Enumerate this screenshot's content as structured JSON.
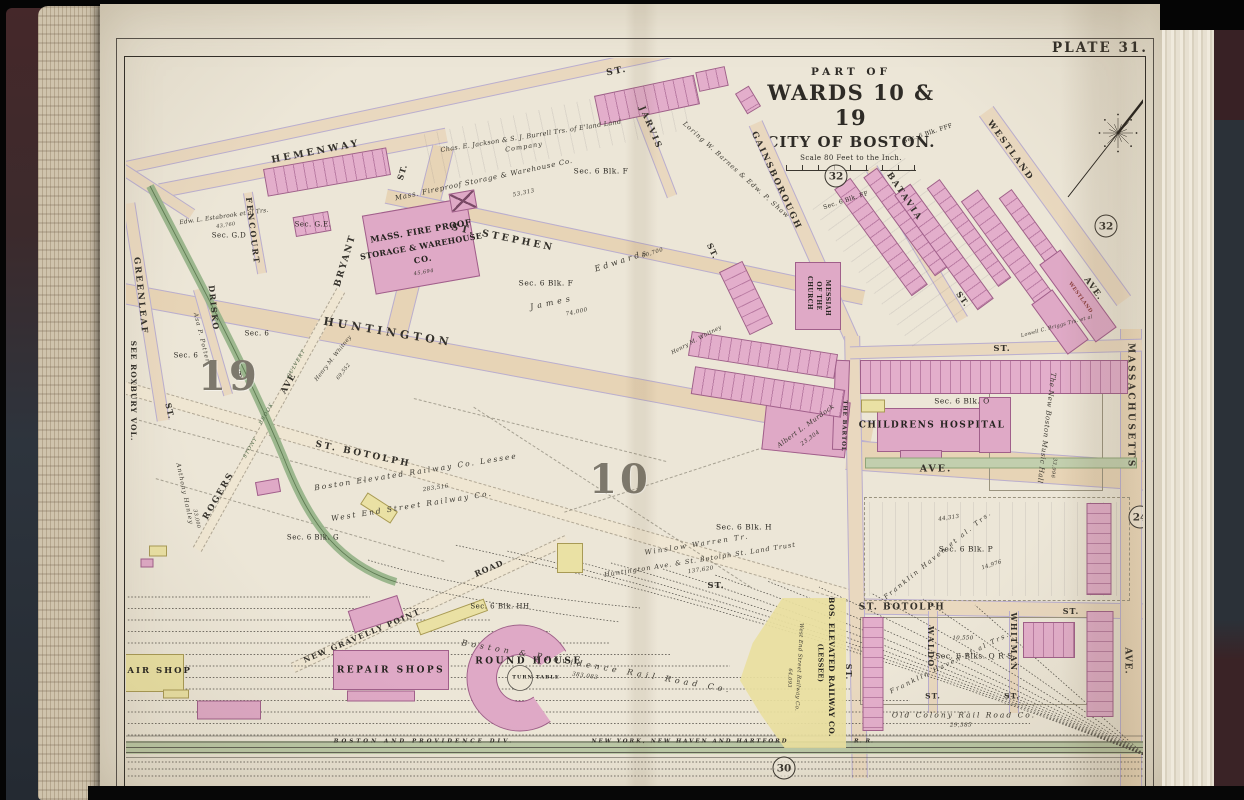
{
  "palette": {
    "page_cream": "#ece6d7",
    "street_fill": "#e9d8bf",
    "street_edge": "#b9aed0",
    "brick_building_pink": "#dfa9c6",
    "wood_building_yellow": "#eae1a4",
    "park_green": "#93b186",
    "ink": "#2c2923"
  },
  "page": {
    "plate_label": "PLATE 31."
  },
  "title_block": {
    "part_of": "PART OF",
    "wards": "WARDS 10 & 19",
    "city": "CITY OF BOSTON.",
    "scale": "Scale 80 Feet to the Inch."
  },
  "wards": {
    "w19": "19",
    "w10": "10"
  },
  "plate_refs": {
    "r32a": "32",
    "r32b": "32",
    "r24": "24",
    "r30": "30"
  },
  "margin_note": "SEE ROXBURY VOL.",
  "streets": {
    "st_top": "ST.",
    "hemenway": "HEMENWAY",
    "fencourt": "FENCOURT",
    "bryant": "BRYANT",
    "bryant_st": "ST.",
    "greenleaf": "GREENLEAF",
    "drisko": "DRISKO",
    "st_stephen": "ST. STEPHEN",
    "huntington": "HUNTINGTON",
    "huntington_ave": "AVE.",
    "gainsborough": "GAINSBOROUGH",
    "jarvis": "JARVIS",
    "batavia": "BATAVIA",
    "batavia_st": "ST.",
    "westland": "WESTLAND",
    "westland_ave": "AVE.",
    "massachusetts": "MASSACHUSETTS",
    "massachusetts_ave": "AVE.",
    "st_botolph_w": "ST. BOTOLPH",
    "st_botolph_e": "ST. BOTOLPH",
    "st_botolph_e_st": "ST.",
    "st_botolph_mid_st": "ST.",
    "rogers": "ROGERS",
    "rogers_ave": "AVE",
    "new_gravelly_point": "NEW GRAVELLY POINT",
    "road": "ROAD",
    "waldo": "WALDO",
    "waldo_st": "ST.",
    "whitman": "WHITMAN",
    "whitman_st": "ST.",
    "st_350": "ST.",
    "st_w1": "ST.",
    "st_w2": "ST.",
    "st_g_mid": "ST.",
    "st_g_low": "ST."
  },
  "culvert": {
    "w1": "STONY",
    "w2": "BROOK",
    "w3": "CULVERT"
  },
  "places": {
    "fireproof_l1": "MASS. FIRE PROOF",
    "fireproof_l2": "STORAGE & WAREHOUSE",
    "fireproof_l3": "CO.",
    "church_l1": "CHURCH",
    "church_l2": "OF THE",
    "church_l3": "MESSIAH",
    "childrens_hospital": "CHILDRENS HOSPITAL",
    "bartol": "THE BARTOL",
    "westland_bldg": "WESTLAND",
    "repair_shop": "REPAIR SHOP",
    "repair_shops": "REPAIR SHOPS",
    "round_house": "ROUND HOUSE",
    "turn_table": "TURN TABLE",
    "bos_elev_1": "BOS. ELEVATED RAILWAY CO.",
    "bos_elev_2": "(LESSEE)",
    "music_hall": "The New Boston Music Hall",
    "music_hall_area": "33,996"
  },
  "owners": {
    "jackson1": "Chas. E. Jackson & S. J. Burrell Trs. of E'land Land",
    "jackson2": "Company",
    "fireproof_owner": "Mass. Fireproof Storage & Warehouse Co.",
    "fireproof_area": "53,313",
    "fireproof_bldg_area": "45,694",
    "estabrook": "Edw. L. Estabrook et al Trs.",
    "estabrook_area": "43,760",
    "barnes": "Loring W. Barnes & Edw. P. Shaw",
    "james": "James",
    "james_area": "74,000",
    "edwards": "Edwards",
    "edwards_area": "60,700",
    "whitney": "Henry M. Whitney",
    "whitney2": "Henry M. Whitney",
    "whitney2_area": "69,552",
    "murdock": "Albert L. Murdock",
    "murdock_area": "23,304",
    "warren1": "Winslow Warren Tr.",
    "warren2": "Huntington Ave. & St. Botolph St. Land Trust",
    "warren_area": "137,620",
    "bera1": "Boston Elevated Railway Co. Lessee",
    "bera2": "West End Street Railway Co.",
    "bera_area": "283,516",
    "potter": "Asa P. Potter",
    "hanley": "Anthony Hanley",
    "hanley_area": "33,000",
    "haven_p": "Franklin Haven et al. Trs.",
    "haven_p_area1": "44,313",
    "haven_p_area2": "14,976",
    "haven_q": "Franklin Haven et al Trs.",
    "haven_q_area": "10,550",
    "briggs": "Lowell C. Briggs Trs. et al",
    "west_end_v": "West End Street Railway Co.",
    "west_end_v_area": "64,093",
    "bp_rr": "Boston & Providence Rail Road Co.",
    "bp_rr_area": "383,083",
    "old_colony": "Old Colony Rail Road Co.",
    "old_colony_area": "29,385"
  },
  "sections": {
    "gd": "Sec. G.D",
    "ge": "Sec. G.E.",
    "s6a": "Sec. 6",
    "s6b": "Sec. 6",
    "f1": "Sec. 6 Blk. F",
    "f2": "Sec. 6 Blk. F",
    "ff": "Sec. 6 Blk. FF",
    "fff": "Sec. 6 Blk. FFF",
    "g": "Sec. 6 Blk. G",
    "h": "Sec. 6 Blk. H",
    "hh": "Sec. 6 Blk. HH",
    "o": "Sec. 6 Blk. O",
    "p": "Sec. 6 Blk. P",
    "qrs": "Sec. 6 Blks. Q R S"
  },
  "railroads": {
    "band1": "BOSTON AND PROVIDENCE DIV.",
    "band2": "NEW YORK, NEW HAVEN AND HARTFORD",
    "band2b": "R. R."
  }
}
